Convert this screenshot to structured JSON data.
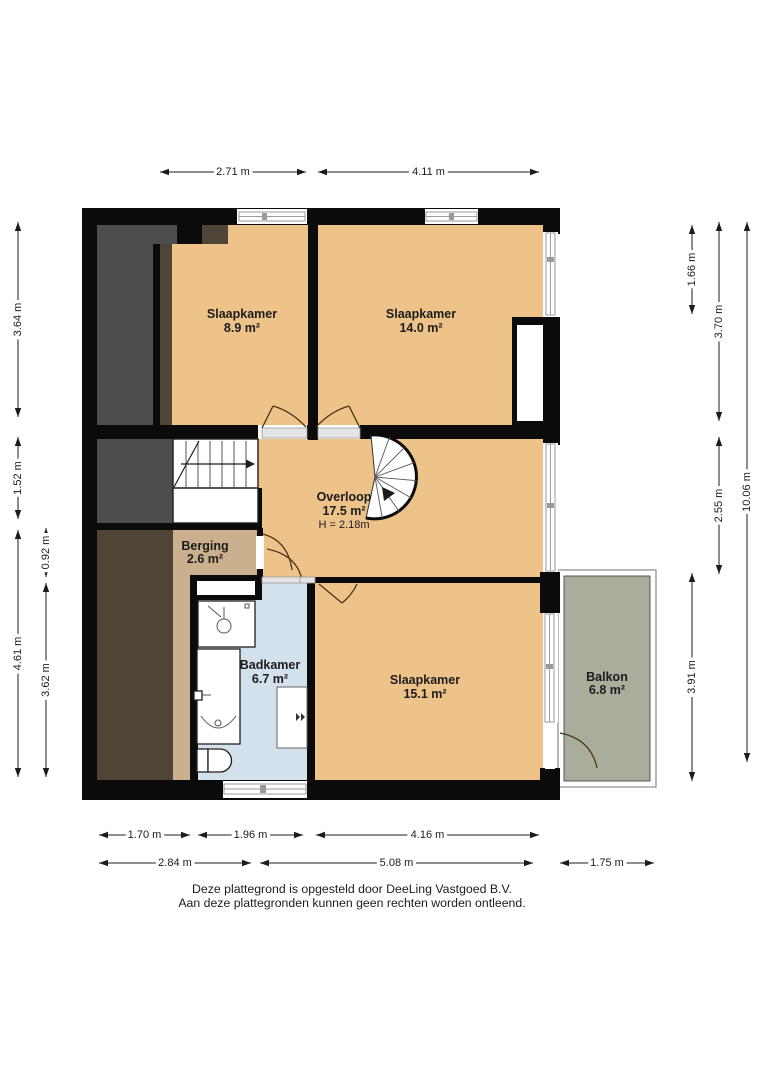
{
  "rooms": [
    {
      "id": "slaapkamer-1",
      "name": "Slaapkamer",
      "area": "8.9 m²"
    },
    {
      "id": "slaapkamer-2",
      "name": "Slaapkamer",
      "area": "14.0 m²"
    },
    {
      "id": "overloop",
      "name": "Overloop",
      "area": "17.5 m²",
      "height": "H = 2.18m"
    },
    {
      "id": "berging",
      "name": "Berging",
      "area": "2.6 m²"
    },
    {
      "id": "badkamer",
      "name": "Badkamer",
      "area": "6.7 m²"
    },
    {
      "id": "slaapkamer-3",
      "name": "Slaapkamer",
      "area": "15.1 m²"
    },
    {
      "id": "balkon",
      "name": "Balkon",
      "area": "6.8 m²"
    }
  ],
  "dimensions": {
    "top": [
      {
        "label": "2.71 m",
        "x1": 160,
        "x2": 306,
        "y": 172
      },
      {
        "label": "4.11 m",
        "x1": 318,
        "x2": 539,
        "y": 172
      }
    ],
    "bottom": [
      {
        "label": "1.70 m",
        "x1": 99,
        "x2": 190,
        "y": 835
      },
      {
        "label": "1.96 m",
        "x1": 198,
        "x2": 303,
        "y": 835
      },
      {
        "label": "4.16 m",
        "x1": 316,
        "x2": 539,
        "y": 835
      },
      {
        "label": "2.84 m",
        "x1": 99,
        "x2": 251,
        "y": 863
      },
      {
        "label": "5.08 m",
        "x1": 260,
        "x2": 533,
        "y": 863
      },
      {
        "label": "1.75 m",
        "x1": 560,
        "x2": 654,
        "y": 863
      }
    ],
    "left": [
      {
        "label": "3.64 m",
        "y1": 222,
        "y2": 417,
        "x": 18
      },
      {
        "label": "1.52 m",
        "y1": 437,
        "y2": 519,
        "x": 18
      },
      {
        "label": "4.61 m",
        "y1": 530,
        "y2": 777,
        "x": 18
      },
      {
        "label": "0.92 m",
        "y1": 528,
        "y2": 577,
        "x": 46
      },
      {
        "label": "3.62 m",
        "y1": 583,
        "y2": 777,
        "x": 46
      }
    ],
    "right": [
      {
        "label": "1.66 m",
        "y1": 225,
        "y2": 314,
        "x": 692
      },
      {
        "label": "3.91 m",
        "y1": 573,
        "y2": 781,
        "x": 692
      },
      {
        "label": "3.70 m",
        "y1": 222,
        "y2": 421,
        "x": 719
      },
      {
        "label": "2.55 m",
        "y1": 437,
        "y2": 574,
        "x": 719
      },
      {
        "label": "10.06 m",
        "y1": 222,
        "y2": 762,
        "x": 747
      }
    ]
  },
  "colors": {
    "floor_orange": "#edc38a",
    "berging_tan": "#cab08d",
    "bath_blue": "#d2e1ec",
    "balcony_green": "#a9ad9b",
    "roof_dark_gray": "#4d4d4f",
    "roof_dark_brown": "#4e4537",
    "wall_black": "#0b0b0b"
  },
  "footer": {
    "line1": "Deze plattegrond is opgesteld door DeeLing Vastgoed B.V.",
    "line2": "Aan deze plattegronden kunnen geen rechten worden ontleend."
  }
}
